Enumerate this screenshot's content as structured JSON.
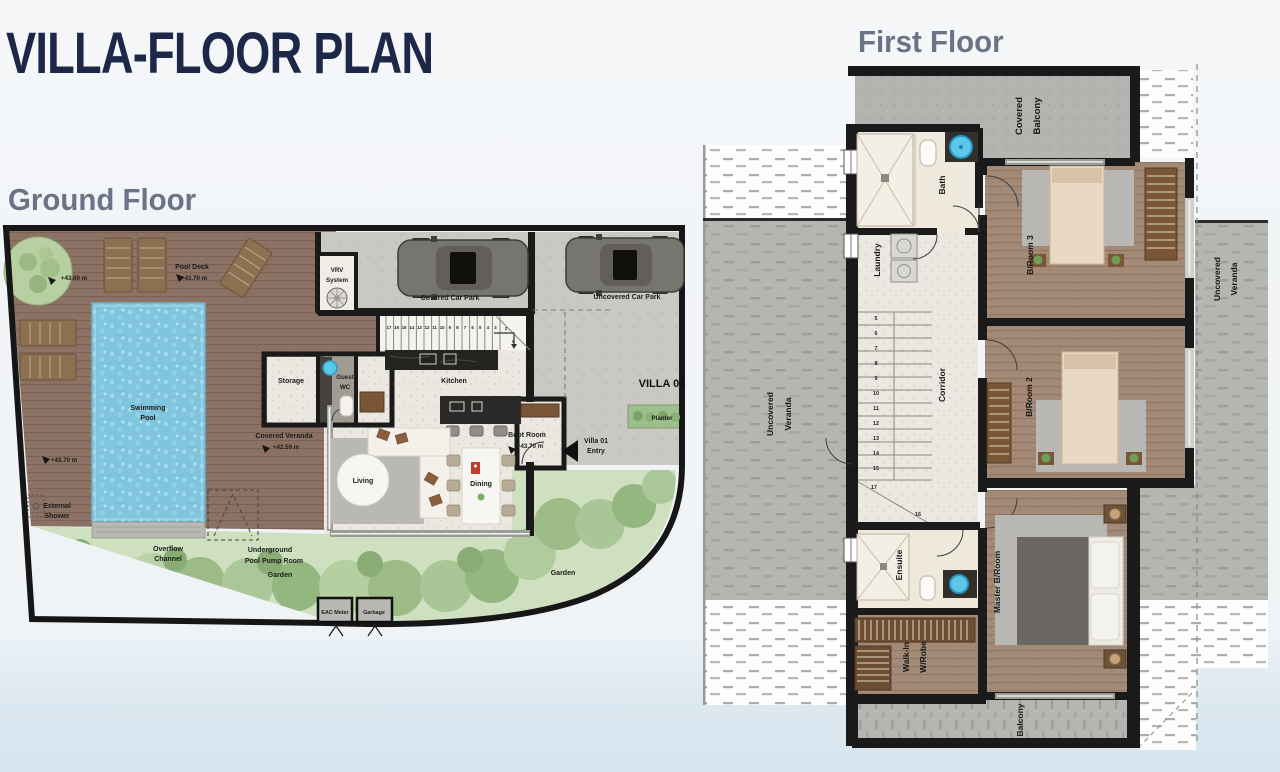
{
  "title": "VILLA-FLOOR PLAN",
  "ground_floor": {
    "heading": "Ground Floor",
    "labels": {
      "tree_level": "+43.60 m",
      "pool_deck": [
        "Pool Deck",
        "+43.70 m"
      ],
      "swimming_pool": [
        "Swimming",
        "Pool"
      ],
      "external_shower": [
        "External",
        "Shower"
      ],
      "deck_level": "+43.70 m",
      "covered_veranda": [
        "Covered Veranda",
        "+42.59 m"
      ],
      "overflow_channel": [
        "Overflow",
        "Channel"
      ],
      "pump_room": [
        "Underground",
        "Pool Pump Room"
      ],
      "garden_mid": "Garden",
      "garden_right": "Garden",
      "storage": "Storage",
      "guest_wc": [
        "Guest",
        "WC"
      ],
      "kitchen": "Kitchen",
      "living": "Living",
      "dining": "Dining",
      "boot_room": [
        "Boot Room",
        "+43.70 m"
      ],
      "villa_entry": [
        "Villa 01",
        "Entry"
      ],
      "villa_01": "VILLA 01",
      "planter": "Planter",
      "vrv_system": [
        "VRV",
        "System"
      ],
      "covered_car_park": "Covered Car Park",
      "uncovered_car_park": "Uncovered Car Park",
      "eac_meter": "EAC Meter",
      "garbage": "Garbage",
      "stairs": [
        "17",
        "16",
        "15",
        "14",
        "13",
        "12",
        "11",
        "10",
        "9",
        "8",
        "7",
        "6",
        "5",
        "4",
        "3",
        "2",
        "1"
      ]
    }
  },
  "first_floor": {
    "heading": "First Floor",
    "labels": {
      "covered_balcony": [
        "Covered",
        "Balcony"
      ],
      "bath": "Bath",
      "laundry": "Laundry",
      "corridor": "Corridor",
      "b_room_3": "B/Room 3",
      "b_room_2": "B/Room 2",
      "master_b_room": "Master B/Room",
      "ensuite": "Ensuite",
      "walk_in_robe": [
        "Walk-In",
        "W/Robe"
      ],
      "balcony": "Balcony",
      "uncovered_veranda_left": [
        "Uncovered",
        "Veranda"
      ],
      "uncovered_veranda_right": [
        "Uncovered",
        "Veranda"
      ],
      "stairs": [
        "5",
        "6",
        "7",
        "8",
        "9",
        "10",
        "11",
        "12",
        "13",
        "14",
        "15",
        "16",
        "17"
      ]
    }
  },
  "colors": {
    "title": "#1d2849",
    "heading": "#6b7486",
    "wall": "#1a1a1a",
    "deck_wood": "#8b7264",
    "floor_wood": "#a28a76",
    "pool": "#7fc5dd",
    "sink_blue": "#5bc8ea",
    "garden": "#cfe0c1",
    "tree": "#a3c18e",
    "planter": "#9fbe8d",
    "veranda_gray": "#b5b5b1",
    "water_band": "#dfe9f2"
  }
}
